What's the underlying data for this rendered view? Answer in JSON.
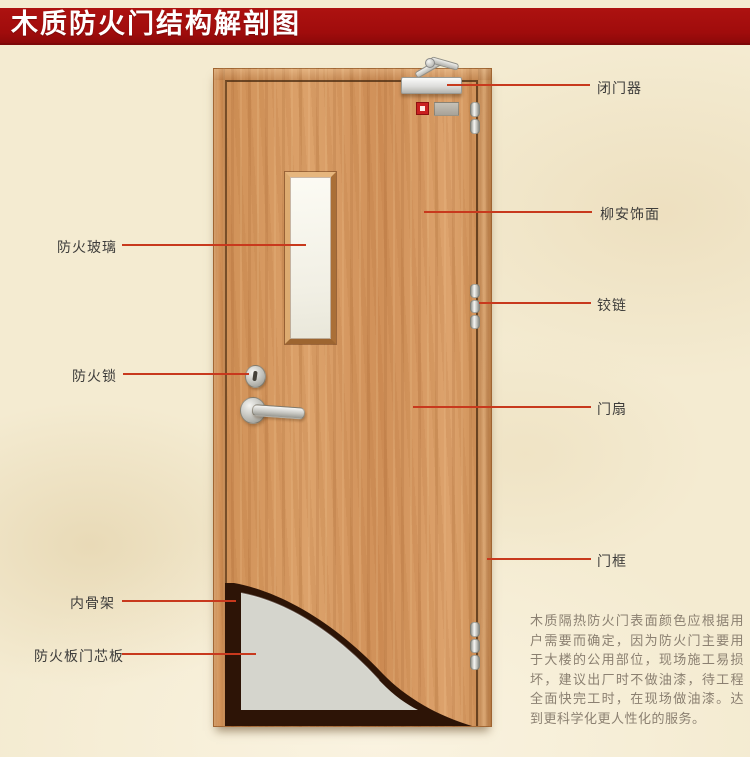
{
  "title": "木质防火门结构解剖图",
  "diagram": {
    "left_labels": [
      {
        "id": "fire-glass",
        "text": "防火玻璃"
      },
      {
        "id": "fire-lock",
        "text": "防火锁"
      },
      {
        "id": "inner-skeleton",
        "text": "内骨架"
      },
      {
        "id": "fire-board-core",
        "text": "防火板门芯板"
      }
    ],
    "right_labels": [
      {
        "id": "door-closer",
        "text": "闭门器"
      },
      {
        "id": "lauan-veneer",
        "text": "柳安饰面"
      },
      {
        "id": "hinge",
        "text": "铰链"
      },
      {
        "id": "door-leaf",
        "text": "门扇"
      },
      {
        "id": "door-frame",
        "text": "门框"
      }
    ],
    "note": "木质隔热防火门表面颜色应根据用户需要而确定，因为防火门主要用于大楼的公用部位，现场施工易损坏，建议出厂时不做油漆，待工程全面快完工时，在现场做油漆。达到更科学化更人性化的服务。"
  },
  "colors": {
    "banner": "#a00c0c",
    "banner_text": "#ffffff",
    "background": "#f4ebd1",
    "arrow_line": "#c8391d",
    "wood": "#d4955e",
    "core_panel": "#d5d5cd",
    "skeleton_dark": "#2d1406",
    "label_text": "#3e3d3b",
    "note_text": "#8b8071"
  }
}
